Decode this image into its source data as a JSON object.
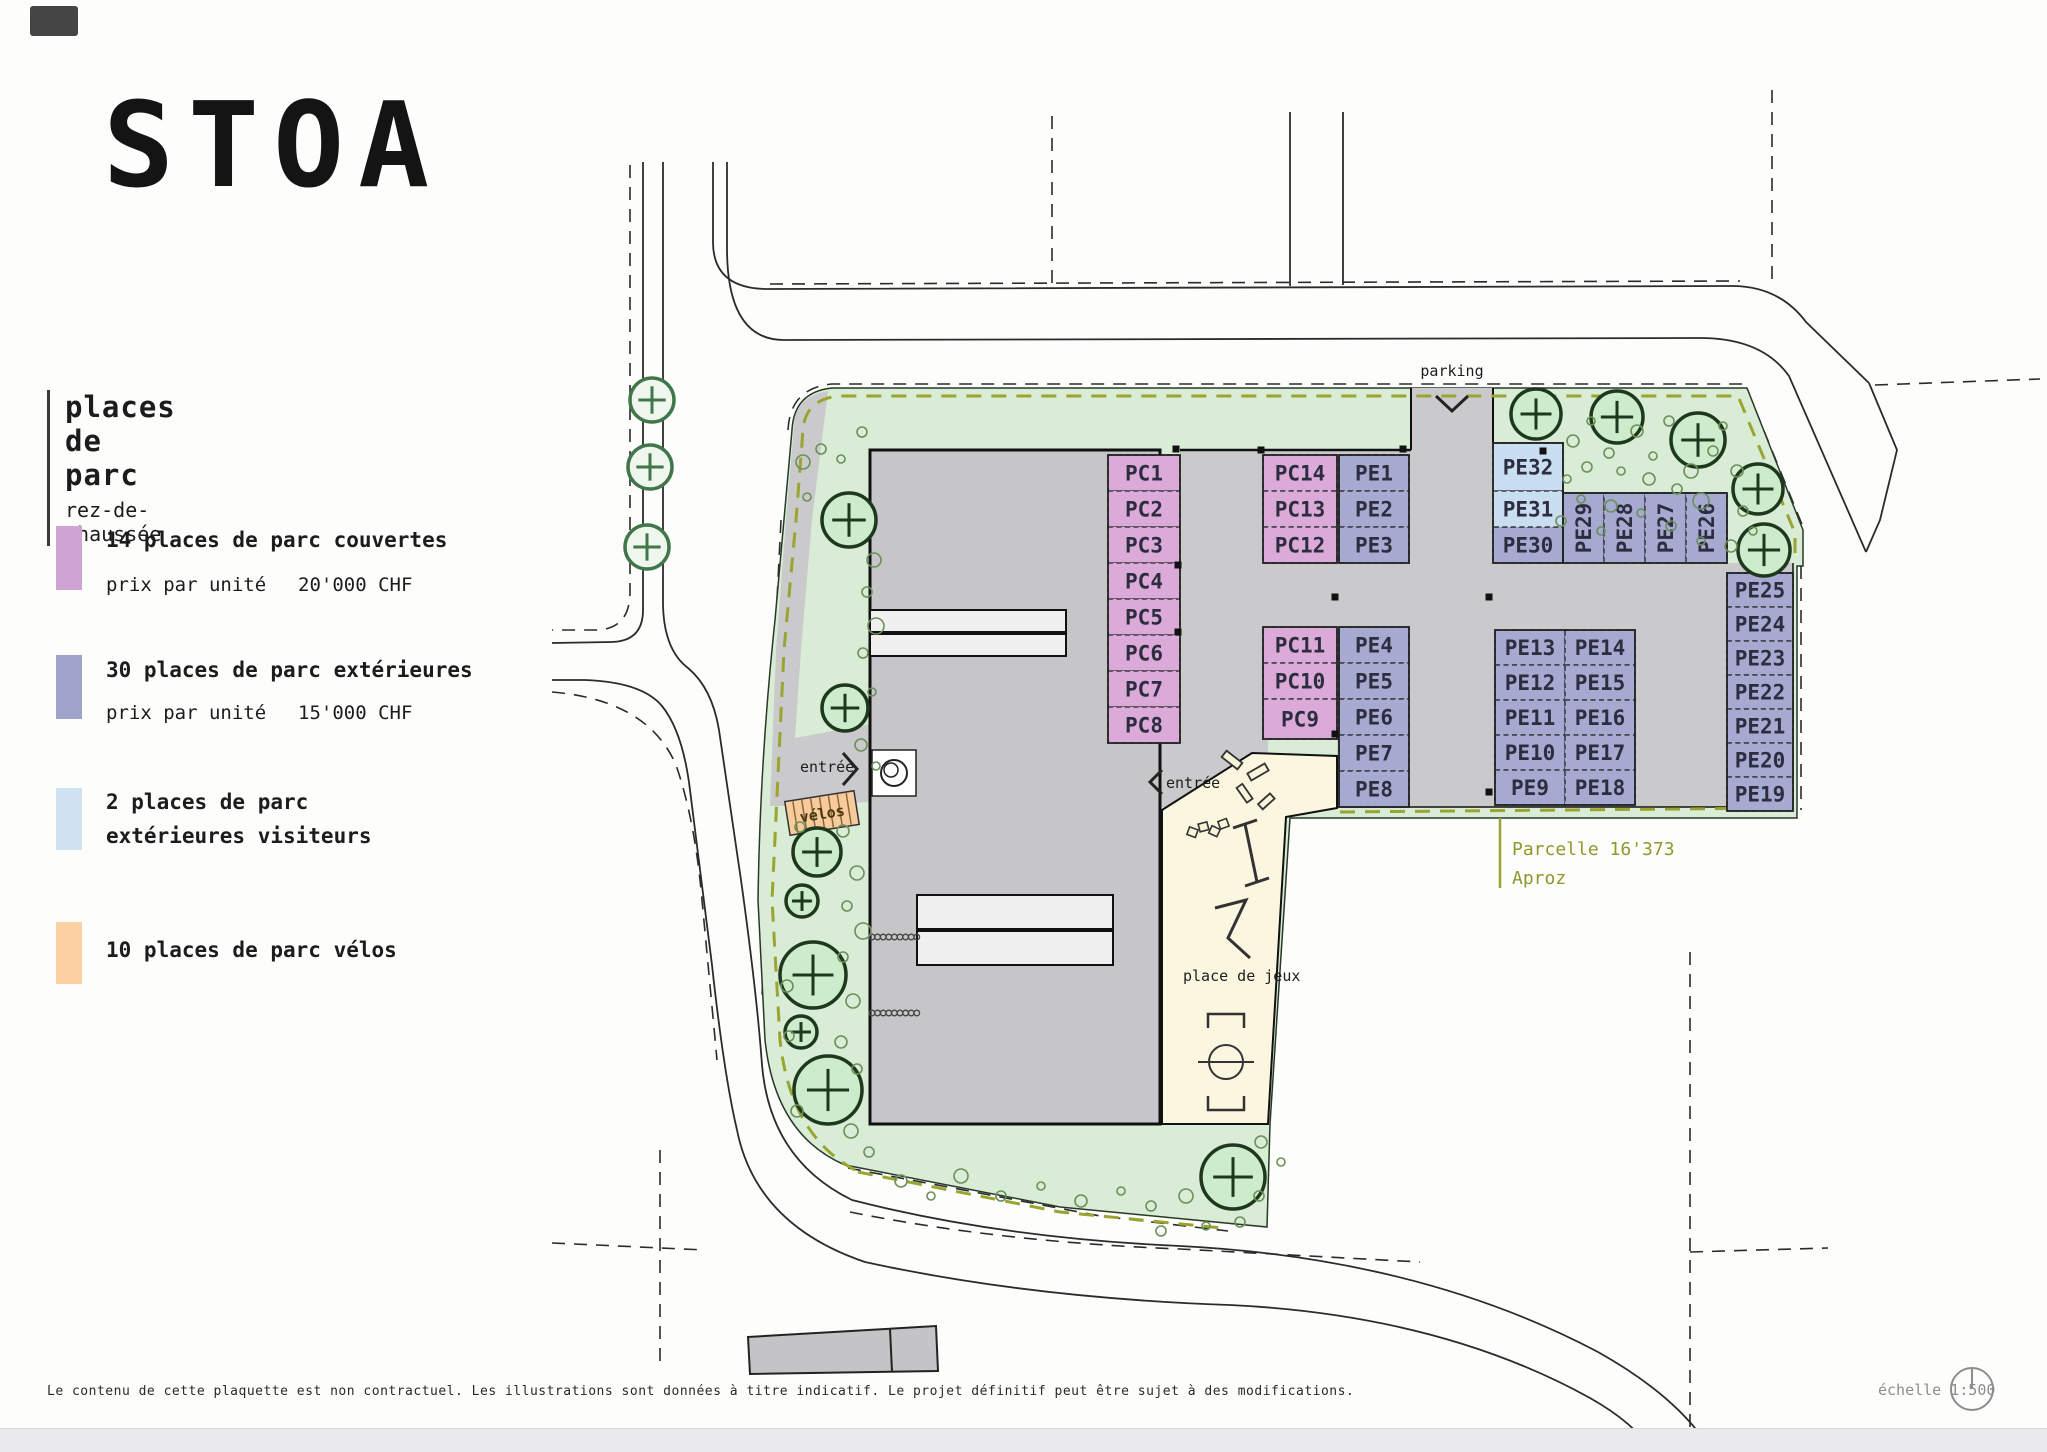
{
  "logo": "STOA",
  "legend": {
    "title": "places de parc",
    "subtitle": "rez-de-chaussée",
    "items": [
      {
        "color": "#cfa3d3",
        "label": "14 places de parc couvertes",
        "price_label": "prix par unité",
        "price": "20'000 CHF"
      },
      {
        "color": "#9fa3cb",
        "label": "30 places de parc extérieures",
        "price_label": "prix par unité",
        "price": "15'000 CHF"
      },
      {
        "color": "#cfe2f2",
        "label_line1": "2 places de parc",
        "label_line2": "extérieures visiteurs"
      },
      {
        "color": "#fbd1a4",
        "label": "10 places de parc vélos"
      }
    ]
  },
  "colors": {
    "covered": "#dcaad9",
    "exterior": "#a6aad1",
    "visitor": "#c9def0",
    "bike": "#f8cb9d",
    "lawn": "#d9ecd6",
    "asphalt": "#cacacc",
    "building": "#c6c6c8",
    "playground": "#faf6df",
    "boundary_olive": "#9aa431",
    "space_border": "#3c3c46",
    "space_text": "#2d2d40",
    "tree_stroke": "#1d381d",
    "tree_fill": "#cdeccb",
    "road_tree_stroke": "#41754a",
    "shrub": "#6b8f5a"
  },
  "plan": {
    "labels": {
      "parking": "parking",
      "entree_left": "entrée",
      "entree_mid": "entrée",
      "velos": "vélos",
      "place_de_jeux": "place de jeux",
      "parcelle_line1": "Parcelle 16'373",
      "parcelle_line2": "Aproz"
    },
    "covered_spaces": [
      {
        "id": "PC1",
        "x": 1108,
        "y": 455,
        "w": 72,
        "h": 36
      },
      {
        "id": "PC2",
        "x": 1108,
        "y": 491,
        "w": 72,
        "h": 36
      },
      {
        "id": "PC3",
        "x": 1108,
        "y": 527,
        "w": 72,
        "h": 36
      },
      {
        "id": "PC4",
        "x": 1108,
        "y": 563,
        "w": 72,
        "h": 36
      },
      {
        "id": "PC5",
        "x": 1108,
        "y": 599,
        "w": 72,
        "h": 36
      },
      {
        "id": "PC6",
        "x": 1108,
        "y": 635,
        "w": 72,
        "h": 36
      },
      {
        "id": "PC7",
        "x": 1108,
        "y": 671,
        "w": 72,
        "h": 36
      },
      {
        "id": "PC8",
        "x": 1108,
        "y": 707,
        "w": 72,
        "h": 36
      },
      {
        "id": "PC14",
        "x": 1263,
        "y": 455,
        "w": 74,
        "h": 36
      },
      {
        "id": "PC13",
        "x": 1263,
        "y": 491,
        "w": 74,
        "h": 36
      },
      {
        "id": "PC12",
        "x": 1263,
        "y": 527,
        "w": 74,
        "h": 36
      },
      {
        "id": "PC11",
        "x": 1263,
        "y": 627,
        "w": 74,
        "h": 36
      },
      {
        "id": "PC10",
        "x": 1263,
        "y": 663,
        "w": 74,
        "h": 36
      },
      {
        "id": "PC9",
        "x": 1263,
        "y": 699,
        "w": 74,
        "h": 40
      }
    ],
    "exterior_spaces": [
      {
        "id": "PE1",
        "x": 1339,
        "y": 455,
        "w": 70,
        "h": 36
      },
      {
        "id": "PE2",
        "x": 1339,
        "y": 491,
        "w": 70,
        "h": 36
      },
      {
        "id": "PE3",
        "x": 1339,
        "y": 527,
        "w": 70,
        "h": 36
      },
      {
        "id": "PE4",
        "x": 1339,
        "y": 627,
        "w": 70,
        "h": 36
      },
      {
        "id": "PE5",
        "x": 1339,
        "y": 663,
        "w": 70,
        "h": 36
      },
      {
        "id": "PE6",
        "x": 1339,
        "y": 699,
        "w": 70,
        "h": 36
      },
      {
        "id": "PE7",
        "x": 1339,
        "y": 735,
        "w": 70,
        "h": 36
      },
      {
        "id": "PE8",
        "x": 1339,
        "y": 771,
        "w": 70,
        "h": 36
      },
      {
        "id": "PE30",
        "x": 1493,
        "y": 527,
        "w": 70,
        "h": 36
      },
      {
        "id": "PE29",
        "x": 1563,
        "y": 493,
        "w": 41,
        "h": 70,
        "vert": true
      },
      {
        "id": "PE28",
        "x": 1604,
        "y": 493,
        "w": 41,
        "h": 70,
        "vert": true
      },
      {
        "id": "PE27",
        "x": 1645,
        "y": 493,
        "w": 41,
        "h": 70,
        "vert": true
      },
      {
        "id": "PE26",
        "x": 1686,
        "y": 493,
        "w": 41,
        "h": 70,
        "vert": true
      },
      {
        "id": "PE13",
        "x": 1495,
        "y": 630,
        "w": 70,
        "h": 35
      },
      {
        "id": "PE12",
        "x": 1495,
        "y": 665,
        "w": 70,
        "h": 35
      },
      {
        "id": "PE11",
        "x": 1495,
        "y": 700,
        "w": 70,
        "h": 35
      },
      {
        "id": "PE10",
        "x": 1495,
        "y": 735,
        "w": 70,
        "h": 35
      },
      {
        "id": "PE9",
        "x": 1495,
        "y": 770,
        "w": 70,
        "h": 35
      },
      {
        "id": "PE14",
        "x": 1565,
        "y": 630,
        "w": 70,
        "h": 35
      },
      {
        "id": "PE15",
        "x": 1565,
        "y": 665,
        "w": 70,
        "h": 35
      },
      {
        "id": "PE16",
        "x": 1565,
        "y": 700,
        "w": 70,
        "h": 35
      },
      {
        "id": "PE17",
        "x": 1565,
        "y": 735,
        "w": 70,
        "h": 35
      },
      {
        "id": "PE18",
        "x": 1565,
        "y": 770,
        "w": 70,
        "h": 35
      },
      {
        "id": "PE25",
        "x": 1727,
        "y": 573,
        "w": 66,
        "h": 34
      },
      {
        "id": "PE24",
        "x": 1727,
        "y": 607,
        "w": 66,
        "h": 34
      },
      {
        "id": "PE23",
        "x": 1727,
        "y": 641,
        "w": 66,
        "h": 34
      },
      {
        "id": "PE22",
        "x": 1727,
        "y": 675,
        "w": 66,
        "h": 34
      },
      {
        "id": "PE21",
        "x": 1727,
        "y": 709,
        "w": 66,
        "h": 34
      },
      {
        "id": "PE20",
        "x": 1727,
        "y": 743,
        "w": 66,
        "h": 34
      },
      {
        "id": "PE19",
        "x": 1727,
        "y": 777,
        "w": 66,
        "h": 34
      }
    ],
    "visitor_spaces": [
      {
        "id": "PE32",
        "x": 1493,
        "y": 443,
        "w": 70,
        "h": 48
      },
      {
        "id": "PE31",
        "x": 1493,
        "y": 491,
        "w": 70,
        "h": 36
      }
    ],
    "block_outlines": [
      [
        1108,
        455,
        72,
        288
      ],
      [
        1263,
        455,
        74,
        108
      ],
      [
        1263,
        627,
        74,
        112
      ],
      [
        1339,
        455,
        70,
        108
      ],
      [
        1339,
        627,
        70,
        180
      ],
      [
        1493,
        443,
        70,
        120
      ],
      [
        1563,
        493,
        164,
        70
      ],
      [
        1495,
        630,
        140,
        175
      ],
      [
        1727,
        573,
        66,
        238
      ]
    ],
    "trees": [
      {
        "x": 849,
        "y": 520,
        "r": 27
      },
      {
        "x": 845,
        "y": 708,
        "r": 23
      },
      {
        "x": 817,
        "y": 852,
        "r": 24
      },
      {
        "x": 802,
        "y": 901,
        "r": 16
      },
      {
        "x": 813,
        "y": 975,
        "r": 33
      },
      {
        "x": 801,
        "y": 1032,
        "r": 16
      },
      {
        "x": 828,
        "y": 1090,
        "r": 34
      },
      {
        "x": 1233,
        "y": 1177,
        "r": 32
      },
      {
        "x": 1536,
        "y": 414,
        "r": 25
      },
      {
        "x": 1617,
        "y": 417,
        "r": 26
      },
      {
        "x": 1698,
        "y": 440,
        "r": 27
      },
      {
        "x": 1758,
        "y": 489,
        "r": 25
      },
      {
        "x": 1764,
        "y": 550,
        "r": 26
      }
    ],
    "road_trees": [
      {
        "x": 652,
        "y": 400,
        "r": 22
      },
      {
        "x": 650,
        "y": 467,
        "r": 22
      },
      {
        "x": 647,
        "y": 547,
        "r": 22
      }
    ],
    "shrubs": [
      [
        803,
        462,
        7
      ],
      [
        821,
        449,
        5
      ],
      [
        841,
        459,
        4
      ],
      [
        807,
        497,
        4
      ],
      [
        862,
        432,
        5
      ],
      [
        874,
        560,
        7
      ],
      [
        867,
        592,
        5
      ],
      [
        876,
        626,
        8
      ],
      [
        863,
        653,
        5
      ],
      [
        872,
        692,
        4
      ],
      [
        861,
        745,
        6
      ],
      [
        876,
        766,
        4
      ],
      [
        800,
        827,
        5
      ],
      [
        843,
        831,
        6
      ],
      [
        857,
        873,
        7
      ],
      [
        847,
        906,
        5
      ],
      [
        863,
        931,
        8
      ],
      [
        843,
        957,
        5
      ],
      [
        787,
        986,
        6
      ],
      [
        853,
        1001,
        7
      ],
      [
        789,
        1036,
        5
      ],
      [
        841,
        1042,
        6
      ],
      [
        857,
        1069,
        5
      ],
      [
        797,
        1111,
        6
      ],
      [
        851,
        1131,
        7
      ],
      [
        869,
        1152,
        5
      ],
      [
        901,
        1181,
        6
      ],
      [
        931,
        1196,
        4
      ],
      [
        961,
        1176,
        7
      ],
      [
        1001,
        1196,
        5
      ],
      [
        1041,
        1186,
        4
      ],
      [
        1081,
        1201,
        6
      ],
      [
        1121,
        1191,
        4
      ],
      [
        1151,
        1206,
        5
      ],
      [
        1186,
        1196,
        7
      ],
      [
        1161,
        1231,
        5
      ],
      [
        1206,
        1226,
        4
      ],
      [
        1261,
        1142,
        6
      ],
      [
        1281,
        1162,
        4
      ],
      [
        1259,
        1196,
        5
      ],
      [
        1240,
        1222,
        5
      ],
      [
        1573,
        441,
        6
      ],
      [
        1591,
        421,
        4
      ],
      [
        1609,
        453,
        5
      ],
      [
        1637,
        431,
        6
      ],
      [
        1653,
        456,
        4
      ],
      [
        1669,
        421,
        5
      ],
      [
        1691,
        471,
        7
      ],
      [
        1713,
        451,
        5
      ],
      [
        1723,
        426,
        4
      ],
      [
        1737,
        471,
        6
      ],
      [
        1701,
        501,
        8
      ],
      [
        1677,
        489,
        5
      ],
      [
        1649,
        479,
        6
      ],
      [
        1621,
        471,
        4
      ],
      [
        1587,
        467,
        5
      ],
      [
        1567,
        479,
        4
      ],
      [
        1743,
        511,
        5
      ],
      [
        1753,
        531,
        4
      ],
      [
        1731,
        546,
        6
      ],
      [
        1701,
        541,
        4
      ],
      [
        1671,
        526,
        5
      ],
      [
        1641,
        513,
        4
      ],
      [
        1611,
        506,
        6
      ],
      [
        1581,
        499,
        4
      ],
      [
        1561,
        521,
        5
      ],
      [
        1601,
        531,
        4
      ]
    ],
    "hedges": [
      {
        "x": 872,
        "y": 937,
        "n": 9,
        "dx": 5.6
      },
      {
        "x": 872,
        "y": 1013,
        "n": 9,
        "dx": 5.6
      }
    ],
    "markers": [
      [
        1261,
        450
      ],
      [
        1178,
        565
      ],
      [
        1178,
        632
      ],
      [
        1335,
        597
      ],
      [
        1335,
        734
      ],
      [
        1403,
        449
      ],
      [
        1489,
        597
      ],
      [
        1543,
        451
      ],
      [
        1176,
        449
      ],
      [
        1489,
        792
      ]
    ]
  },
  "footer": {
    "disclaimer": "Le contenu de cette plaquette est non contractuel. Les illustrations sont données à titre indicatif. Le projet définitif peut être sujet à des modifications.",
    "scale_label": "échelle 1:500"
  }
}
